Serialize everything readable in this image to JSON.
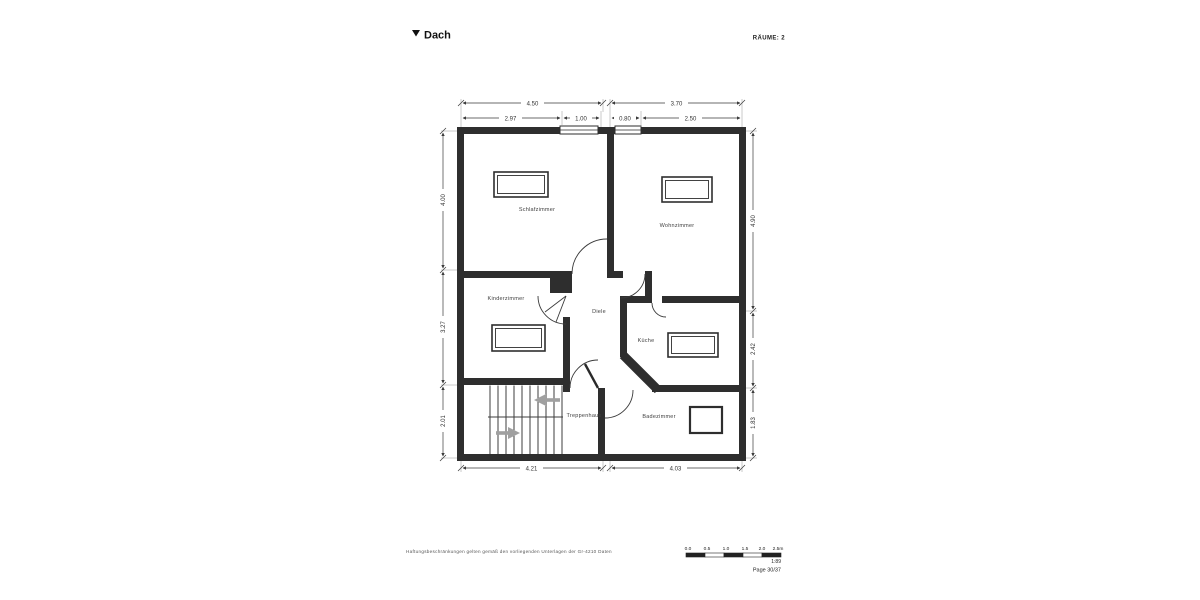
{
  "header": {
    "title": "Dach",
    "rooms_label": "RÄUME: 2"
  },
  "plan": {
    "rooms": [
      {
        "label": "Schlafzimmer"
      },
      {
        "label": "Wohnzimmer"
      },
      {
        "label": "Kinderzimmer"
      },
      {
        "label": "Diele"
      },
      {
        "label": "Küche"
      },
      {
        "label": "Treppenhaus"
      },
      {
        "label": "Badezimmer"
      }
    ],
    "dims": {
      "top": [
        "4.50",
        "3.70"
      ],
      "top_inner": [
        "2.97",
        "1.00",
        "0.80",
        "2.50"
      ],
      "left": [
        "4.00",
        "3.27",
        "2.01"
      ],
      "right": [
        "4.90",
        "2.42",
        "1.83"
      ],
      "bottom": [
        "4.21",
        "4.03"
      ]
    }
  },
  "footer": {
    "disclaimer": "Haftungsbeschränkungen gelten gemäß den vorliegenden Unterlagen der Gr-4210 Daten",
    "scale": {
      "ticks": [
        "0.0",
        "0.5",
        "1.0",
        "1.5",
        "2.0",
        "2.5m"
      ],
      "ratio": "1:89",
      "page": "Page 30/37"
    }
  },
  "colors": {
    "wall": "#2e2e2e",
    "line": "#3a3a3a",
    "text": "#333333",
    "arrow": "#a0a0a0"
  }
}
